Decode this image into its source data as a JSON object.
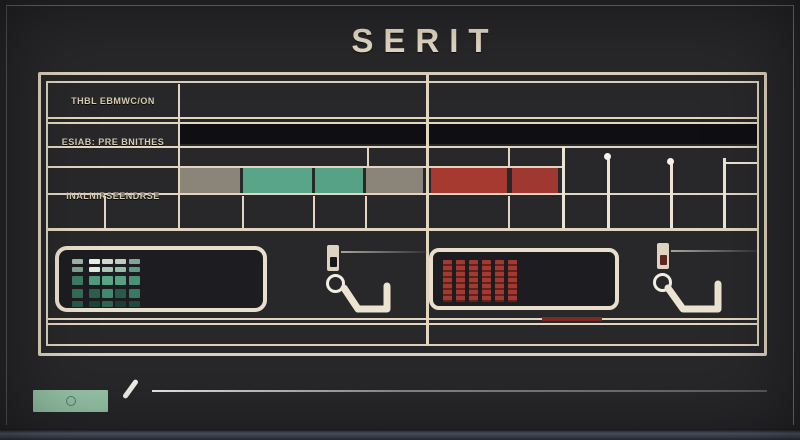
{
  "title": "SERIT",
  "colors": {
    "background": "#28282b",
    "grid_line": "#e2d6c1",
    "black_bar": "#0f0f13",
    "gray_cell": "#8b8478",
    "teal_cell": "#57a58a",
    "red_cell": "#a63a31",
    "bottom_edge": "#5a6173"
  },
  "icons": [
    "plug-icon",
    "circle-indicator-icon",
    "hook-icon",
    "pencil-slash-icon",
    "dot-pin-icon"
  ],
  "table": {
    "rows": [
      {
        "label": "THBL EBMWC/ON"
      },
      {
        "label": "ESIAB: PRE BNITHES"
      },
      {
        "label": "INALNIRSEENDRSE"
      }
    ],
    "timeline": {
      "cells": [
        {
          "name": "gray-1",
          "x": 180,
          "w": 60,
          "color": "#8b8478"
        },
        {
          "name": "teal-1",
          "x": 243,
          "w": 69,
          "color": "#58a58a"
        },
        {
          "name": "teal-2",
          "x": 315,
          "w": 48,
          "color": "#55a287"
        },
        {
          "name": "gray-2",
          "x": 366,
          "w": 57,
          "color": "#8b8478"
        },
        {
          "name": "red-1",
          "x": 431,
          "w": 76,
          "color": "#a63a31"
        },
        {
          "name": "red-2",
          "x": 512,
          "w": 46,
          "color": "#9e3830"
        }
      ],
      "pins": [
        {
          "x": 562,
          "top": 147,
          "dot": false,
          "branch": false
        },
        {
          "x": 607,
          "top": 158,
          "dot": true,
          "branch": false
        },
        {
          "x": 670,
          "top": 163,
          "dot": true,
          "branch": false
        },
        {
          "x": 723,
          "top": 158,
          "dot": false,
          "branch": true
        }
      ],
      "dividers_upper": [
        367,
        508
      ],
      "dividers_lower": [
        104,
        242,
        313,
        365,
        508
      ]
    }
  },
  "panels": {
    "led_matrix": {
      "rows": [
        [
          "#9db3a6",
          "#e8ece6",
          "#cfd9d0",
          "#b9cdc1",
          "#7fa693"
        ],
        [
          "#7da18f",
          "#e0e8e2",
          "#a8c7b6",
          "#8fc0aa",
          "#5d9c82"
        ],
        [
          "#3e7a64",
          "#4f9b7d",
          "#5aa586",
          "#57a182",
          "#4b9177"
        ],
        [
          "#356b57",
          "#2d5f4d",
          "#3f8a6e",
          "#2a5a49",
          "#357a62"
        ],
        [
          "#2a5848",
          "#1f4236",
          "#2f6450",
          "#1d3d32",
          "#224a3c"
        ]
      ]
    },
    "bar_display": {
      "bar_count": 6,
      "bar_color": "#a23a32",
      "stripe_color": "#64201b"
    },
    "underline_segment": {
      "color": "#7c2b24"
    }
  },
  "footer": {
    "button_color": "#99c9ab"
  }
}
